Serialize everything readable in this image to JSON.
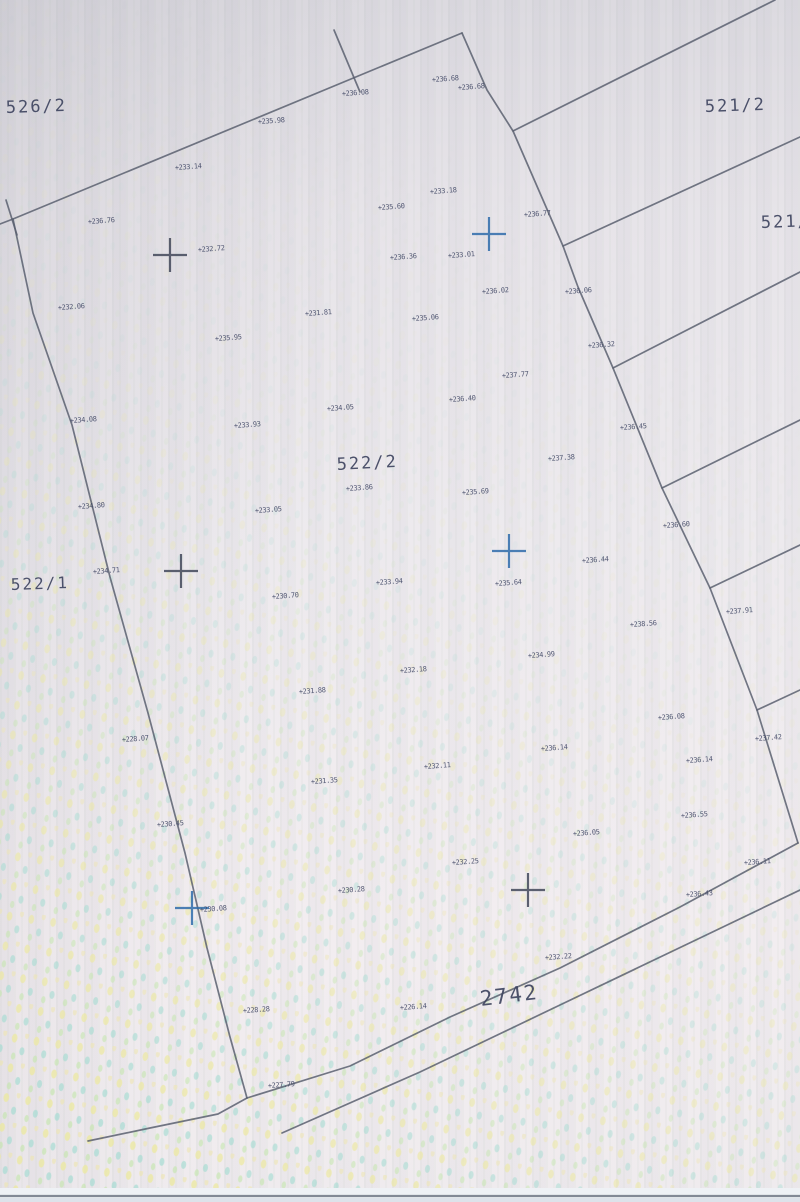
{
  "map": {
    "colors": {
      "boundary_line": "#5b6070",
      "label_ink": "#3e4563",
      "cross_blue": "#2f6cab",
      "cross_dark": "#42485a",
      "paper_top": "#dcdae0",
      "paper_bottom": "#f2edf0",
      "halftone_yellow": "#ece9a0",
      "halftone_cyan": "#a4dcd2",
      "halftone_green": "#c4e6ac",
      "scan_edge_line": "#5f6775",
      "scan_edge_strip": "#eef1f5"
    },
    "parcel_labels": [
      {
        "text": "526/2",
        "x": 6,
        "y": 113,
        "size": 17,
        "rot": -2
      },
      {
        "text": "521/2",
        "x": 705,
        "y": 112,
        "size": 17,
        "rot": -2
      },
      {
        "text": "521/1",
        "x": 761,
        "y": 228,
        "size": 17,
        "rot": -2
      },
      {
        "text": "522/2",
        "x": 337,
        "y": 470,
        "size": 17,
        "rot": -3
      },
      {
        "text": "522/1",
        "x": 11,
        "y": 590,
        "size": 16,
        "rot": -2
      },
      {
        "text": "2742",
        "x": 481,
        "y": 1006,
        "size": 21,
        "rot": -7
      }
    ],
    "grid_crosses": [
      {
        "x": 170,
        "y": 255,
        "color": "dark"
      },
      {
        "x": 489,
        "y": 234,
        "color": "blue"
      },
      {
        "x": 181,
        "y": 571,
        "color": "dark"
      },
      {
        "x": 509,
        "y": 551,
        "color": "blue"
      },
      {
        "x": 192,
        "y": 908,
        "color": "blue"
      },
      {
        "x": 528,
        "y": 890,
        "color": "dark"
      }
    ],
    "elevation_points": [
      {
        "v": "+236.08",
        "x": 342,
        "y": 96
      },
      {
        "v": "+235.98",
        "x": 258,
        "y": 124
      },
      {
        "v": "+233.14",
        "x": 175,
        "y": 170
      },
      {
        "v": "+236.68",
        "x": 432,
        "y": 82
      },
      {
        "v": "+236.68",
        "x": 458,
        "y": 90
      },
      {
        "v": "+233.18",
        "x": 430,
        "y": 194
      },
      {
        "v": "+235.60",
        "x": 378,
        "y": 210
      },
      {
        "v": "+236.76",
        "x": 88,
        "y": 224
      },
      {
        "v": "+236.77",
        "x": 524,
        "y": 217
      },
      {
        "v": "+232.72",
        "x": 198,
        "y": 252
      },
      {
        "v": "+236.36",
        "x": 390,
        "y": 260
      },
      {
        "v": "+233.01",
        "x": 448,
        "y": 258
      },
      {
        "v": "+236.02",
        "x": 482,
        "y": 294
      },
      {
        "v": "+236.06",
        "x": 565,
        "y": 294
      },
      {
        "v": "+232.06",
        "x": 58,
        "y": 310
      },
      {
        "v": "+231.81",
        "x": 305,
        "y": 316
      },
      {
        "v": "+235.06",
        "x": 412,
        "y": 321
      },
      {
        "v": "+235.95",
        "x": 215,
        "y": 341
      },
      {
        "v": "+236.32",
        "x": 588,
        "y": 348
      },
      {
        "v": "+237.77",
        "x": 502,
        "y": 378
      },
      {
        "v": "+236.40",
        "x": 449,
        "y": 402
      },
      {
        "v": "+234.05",
        "x": 327,
        "y": 411
      },
      {
        "v": "+233.93",
        "x": 234,
        "y": 428
      },
      {
        "v": "+236.45",
        "x": 620,
        "y": 430
      },
      {
        "v": "+234.08",
        "x": 70,
        "y": 423
      },
      {
        "v": "+237.38",
        "x": 548,
        "y": 461
      },
      {
        "v": "+233.86",
        "x": 346,
        "y": 491
      },
      {
        "v": "+235.69",
        "x": 462,
        "y": 495
      },
      {
        "v": "+233.05",
        "x": 255,
        "y": 513
      },
      {
        "v": "+234.80",
        "x": 78,
        "y": 509
      },
      {
        "v": "+236.60",
        "x": 663,
        "y": 528
      },
      {
        "v": "+236.44",
        "x": 582,
        "y": 563
      },
      {
        "v": "+234.71",
        "x": 93,
        "y": 574
      },
      {
        "v": "+235.64",
        "x": 495,
        "y": 586
      },
      {
        "v": "+233.94",
        "x": 376,
        "y": 585
      },
      {
        "v": "+230.70",
        "x": 272,
        "y": 599
      },
      {
        "v": "+237.91",
        "x": 726,
        "y": 614
      },
      {
        "v": "+238.56",
        "x": 630,
        "y": 627
      },
      {
        "v": "+234.99",
        "x": 528,
        "y": 658
      },
      {
        "v": "+232.18",
        "x": 400,
        "y": 673
      },
      {
        "v": "+231.88",
        "x": 299,
        "y": 694
      },
      {
        "v": "+236.08",
        "x": 658,
        "y": 720
      },
      {
        "v": "+228.07",
        "x": 122,
        "y": 742
      },
      {
        "v": "+236.14",
        "x": 541,
        "y": 751
      },
      {
        "v": "+237.42",
        "x": 755,
        "y": 741
      },
      {
        "v": "+236.14",
        "x": 686,
        "y": 763
      },
      {
        "v": "+232.11",
        "x": 424,
        "y": 769
      },
      {
        "v": "+231.35",
        "x": 311,
        "y": 784
      },
      {
        "v": "+236.55",
        "x": 681,
        "y": 818
      },
      {
        "v": "+230.45",
        "x": 157,
        "y": 827
      },
      {
        "v": "+236.05",
        "x": 573,
        "y": 836
      },
      {
        "v": "+232.25",
        "x": 452,
        "y": 865
      },
      {
        "v": "+236.11",
        "x": 744,
        "y": 865
      },
      {
        "v": "+236.43",
        "x": 686,
        "y": 897
      },
      {
        "v": "+230.28",
        "x": 338,
        "y": 893
      },
      {
        "v": "+230.08",
        "x": 200,
        "y": 912
      },
      {
        "v": "+228.28",
        "x": 243,
        "y": 1013
      },
      {
        "v": "+226.14",
        "x": 400,
        "y": 1010
      },
      {
        "v": "+227.79",
        "x": 268,
        "y": 1088
      },
      {
        "v": "+232.22",
        "x": 545,
        "y": 960
      }
    ],
    "boundaries": {
      "top-line": [
        [
          0,
          224
        ],
        [
          13,
          219
        ],
        [
          462,
          33
        ]
      ],
      "apex-tick": [
        [
          334,
          30
        ],
        [
          360,
          92
        ]
      ],
      "corner-tick": [
        [
          6,
          200
        ],
        [
          17,
          235
        ]
      ],
      "right-boundary": [
        [
          462,
          33
        ],
        [
          487,
          90
        ],
        [
          513,
          131
        ],
        [
          563,
          246
        ],
        [
          578,
          287
        ],
        [
          613,
          368
        ],
        [
          662,
          488
        ],
        [
          710,
          588
        ],
        [
          757,
          710
        ],
        [
          798,
          843
        ]
      ],
      "left-boundary": [
        [
          13,
          219
        ],
        [
          33,
          313
        ],
        [
          72,
          425
        ],
        [
          110,
          577
        ],
        [
          148,
          713
        ],
        [
          185,
          853
        ],
        [
          207,
          948
        ],
        [
          230,
          1037
        ],
        [
          247,
          1098
        ]
      ],
      "bottom-left-line": [
        [
          88,
          1141
        ],
        [
          150,
          1128
        ],
        [
          218,
          1114
        ],
        [
          247,
          1098
        ]
      ],
      "road-edge-upper": [
        [
          247,
          1098
        ],
        [
          350,
          1066
        ],
        [
          450,
          1017
        ],
        [
          560,
          968
        ],
        [
          680,
          907
        ],
        [
          798,
          843
        ]
      ],
      "road-edge-lower": [
        [
          282,
          1133
        ],
        [
          420,
          1072
        ],
        [
          560,
          1005
        ],
        [
          700,
          938
        ],
        [
          800,
          890
        ]
      ],
      "strip-line-1": [
        [
          513,
          131
        ],
        [
          775,
          0
        ]
      ],
      "strip-line-2": [
        [
          563,
          246
        ],
        [
          800,
          137
        ]
      ],
      "strip-line-3": [
        [
          613,
          368
        ],
        [
          800,
          272
        ]
      ],
      "strip-line-4": [
        [
          662,
          488
        ],
        [
          800,
          420
        ]
      ],
      "strip-line-5": [
        [
          710,
          588
        ],
        [
          800,
          545
        ]
      ],
      "strip-line-6": [
        [
          757,
          710
        ],
        [
          800,
          690
        ]
      ]
    }
  }
}
